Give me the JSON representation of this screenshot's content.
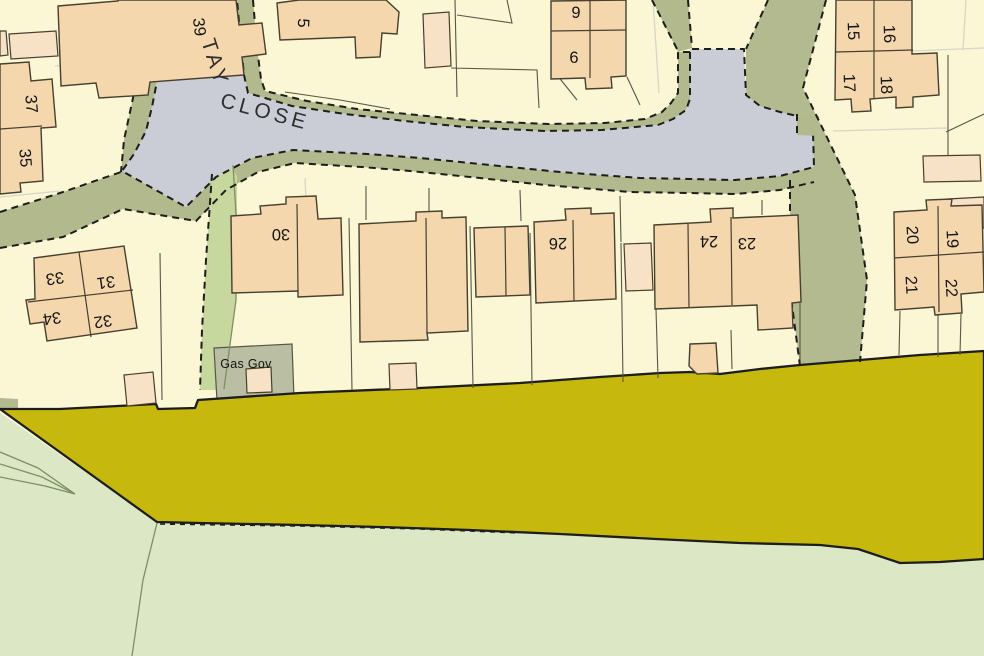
{
  "map": {
    "street": {
      "tay": "TAY",
      "close": "CLOSE"
    },
    "gas_governor_label": "Gas Gov",
    "house_numbers": {
      "h39": "39",
      "h37": "37",
      "h35": "35",
      "h5": "5",
      "h9": "9",
      "h6": "6",
      "h15": "15",
      "h16": "16",
      "h17": "17",
      "h18": "18",
      "h30": "30",
      "h26": "26",
      "h24": "24",
      "h23": "23",
      "h20": "20",
      "h19": "19",
      "h21": "21",
      "h22": "22",
      "h33": "33",
      "h31": "31",
      "h34": "34",
      "h32": "32"
    }
  },
  "colors": {
    "cream": "#fbf6d3",
    "peach": "#f5d7ad",
    "peach_light": "#f8e2c6",
    "road": "#cbcdd6",
    "verge": "#b2b98c",
    "khaki": "#b3ba90",
    "gas": "#babea3",
    "strip": "#c6d89e",
    "field": "#dce8c5",
    "yellow": "#c7b80d",
    "ink": "#1d1d1b",
    "outline": "#473f30",
    "line_dark": "#56564a",
    "line_light": "#d6d6ca",
    "green_line": "#7d8f63",
    "text": "#141414"
  }
}
